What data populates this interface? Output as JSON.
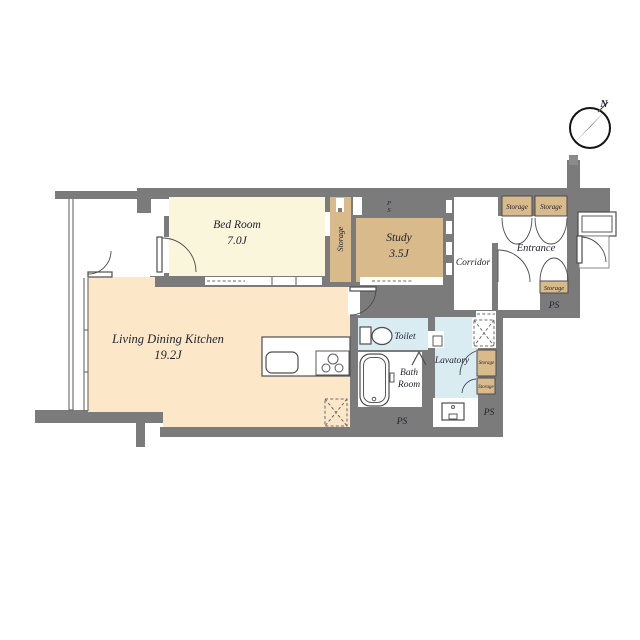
{
  "compass": {
    "north_label": "N"
  },
  "rooms": {
    "living_dining_kitchen": {
      "name": "Living Dining Kitchen",
      "size": "19.2J"
    },
    "bed_room": {
      "name": "Bed Room",
      "size": "7.0J"
    },
    "study": {
      "name": "Study",
      "size": "3.5J"
    },
    "corridor": {
      "name": "Corridor"
    },
    "entrance": {
      "name": "Entrance"
    },
    "toilet": {
      "name": "Toilet"
    },
    "bath_room": {
      "line1": "Bath",
      "line2": "Room"
    },
    "lavatory": {
      "name": "Lavatory"
    }
  },
  "closets": {
    "bedroom_storage": "Storage",
    "entrance_storage_left": "Storage",
    "entrance_storage_right": "Storage",
    "entrance_storage_lower": "Storage",
    "lavatory_storage_upper": "Storage",
    "lavatory_storage_lower": "Storage"
  },
  "shafts": {
    "ps_wall_top": {
      "line1": "P",
      "line2": "S"
    },
    "ps_entrance": "PS",
    "ps_bath": "PS",
    "ps_lavatory": "PS"
  },
  "colors": {
    "wall": "#7b7b7b",
    "bedroom_floor": "#faf6dc",
    "ldk_floor": "#fce8c8",
    "closet": "#d8ba8b",
    "wet_area": "#d8ecf2"
  }
}
